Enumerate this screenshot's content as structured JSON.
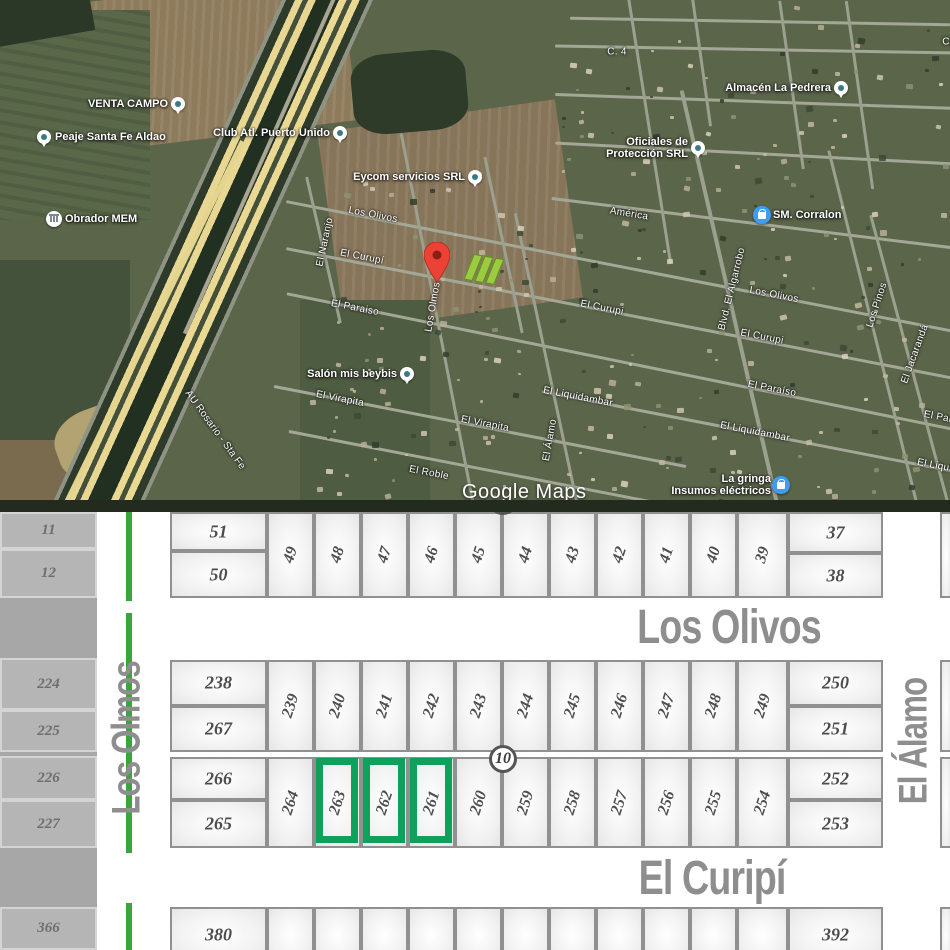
{
  "map": {
    "attribution": "Google Maps",
    "route_label": "AU Rosario - Sta Fe",
    "marker_color": "#ea4335",
    "lot_highlight_color": "#9ccb3f",
    "pois": [
      {
        "type": "place",
        "label": "VENTA CAMPO",
        "x": 178,
        "y": 104,
        "side": "left"
      },
      {
        "type": "place",
        "label": "Peaje Santa Fe Aldao",
        "x": 44,
        "y": 137,
        "side": "right"
      },
      {
        "type": "place",
        "label": "Club Atl. Puerto Unido",
        "x": 340,
        "y": 133,
        "side": "left"
      },
      {
        "type": "place",
        "label": "Eycom servicios SRL",
        "x": 475,
        "y": 177,
        "side": "left"
      },
      {
        "type": "place",
        "label": "Almacén La Pedrera",
        "x": 841,
        "y": 88,
        "side": "left"
      },
      {
        "type": "place",
        "label": "Oficiales de",
        "label2": "Protección SRL",
        "x": 698,
        "y": 148,
        "side": "left"
      },
      {
        "type": "place",
        "label": "Salón mis beybis",
        "x": 407,
        "y": 374,
        "side": "left"
      },
      {
        "type": "shop",
        "label": "SM. Corralon",
        "x": 762,
        "y": 215,
        "side": "right"
      },
      {
        "type": "shop",
        "label": "La gringa",
        "label2": "Insumos eléctricos",
        "x": 781,
        "y": 485,
        "side": "left"
      },
      {
        "type": "civic",
        "label": "Obrador MEM",
        "x": 54,
        "y": 219,
        "side": "right"
      }
    ],
    "street_labels": [
      {
        "text": "C. 4",
        "x": 617,
        "y": 52,
        "rot": 0
      },
      {
        "text": "C. 4",
        "x": 952,
        "y": 42,
        "rot": 0
      },
      {
        "text": "Los Olivos",
        "x": 373,
        "y": 215,
        "rot": 11
      },
      {
        "text": "Los Olivos",
        "x": 774,
        "y": 295,
        "rot": 11
      },
      {
        "text": "El Curupí",
        "x": 362,
        "y": 257,
        "rot": 11
      },
      {
        "text": "El Curupi",
        "x": 602,
        "y": 308,
        "rot": 11
      },
      {
        "text": "El Curupi",
        "x": 762,
        "y": 337,
        "rot": 11
      },
      {
        "text": "El Paraiso",
        "x": 355,
        "y": 308,
        "rot": 11
      },
      {
        "text": "El Paraíso",
        "x": 772,
        "y": 389,
        "rot": 11
      },
      {
        "text": "El Paraíso",
        "x": 948,
        "y": 419,
        "rot": 11
      },
      {
        "text": "El Naranjo",
        "x": 325,
        "y": 242,
        "rot": -78
      },
      {
        "text": "Los Olmos",
        "x": 433,
        "y": 307,
        "rot": -80
      },
      {
        "text": "América",
        "x": 629,
        "y": 214,
        "rot": 9
      },
      {
        "text": "Blvd. El Algarrobo",
        "x": 732,
        "y": 289,
        "rot": -76
      },
      {
        "text": "Los Pinos",
        "x": 877,
        "y": 305,
        "rot": -72
      },
      {
        "text": "El Jacarandá",
        "x": 915,
        "y": 354,
        "rot": -70
      },
      {
        "text": "El Álamo",
        "x": 550,
        "y": 440,
        "rot": -80
      },
      {
        "text": "El Virapita",
        "x": 340,
        "y": 399,
        "rot": 11
      },
      {
        "text": "El Virapita",
        "x": 485,
        "y": 424,
        "rot": 11
      },
      {
        "text": "El Liquidambar",
        "x": 578,
        "y": 397,
        "rot": 11
      },
      {
        "text": "El Liquidambar",
        "x": 755,
        "y": 432,
        "rot": 11
      },
      {
        "text": "El Liquidambar",
        "x": 952,
        "y": 469,
        "rot": 11
      },
      {
        "text": "El Roble",
        "x": 429,
        "y": 473,
        "rot": 11
      },
      {
        "text": "AU Rosario - Sta Fe",
        "x": 215,
        "y": 430,
        "rot": 54
      }
    ]
  },
  "plat": {
    "accent_green": "#0da15c",
    "divider_green": "#3aa53c",
    "block_number": "10",
    "streets": {
      "north": "Los Olivos",
      "south": "El Curipí",
      "west": "Los Olmos",
      "east": "El Álamo"
    },
    "highlighted_lots": [
      "263",
      "262",
      "261"
    ],
    "left_strip_lots": [
      {
        "n": "11",
        "y": 0,
        "h": 37
      },
      {
        "n": "12",
        "y": 37,
        "h": 49
      },
      {
        "n": "224",
        "y": 146,
        "h": 52
      },
      {
        "n": "225",
        "y": 198,
        "h": 42
      },
      {
        "n": "226",
        "y": 244,
        "h": 44
      },
      {
        "n": "227",
        "y": 288,
        "h": 48
      },
      {
        "n": "366",
        "y": 395,
        "h": 43
      }
    ],
    "lots": [
      {
        "n": "51",
        "x": 170,
        "y": 0,
        "w": 97,
        "h": 39
      },
      {
        "n": "50",
        "x": 170,
        "y": 39,
        "w": 97,
        "h": 47
      },
      {
        "n": "49",
        "x": 267,
        "y": 0,
        "w": 47,
        "h": 86,
        "rot": 1
      },
      {
        "n": "48",
        "x": 314,
        "y": 0,
        "w": 47,
        "h": 86,
        "rot": 1
      },
      {
        "n": "47",
        "x": 361,
        "y": 0,
        "w": 47,
        "h": 86,
        "rot": 1
      },
      {
        "n": "46",
        "x": 408,
        "y": 0,
        "w": 47,
        "h": 86,
        "rot": 1
      },
      {
        "n": "45",
        "x": 455,
        "y": 0,
        "w": 47,
        "h": 86,
        "rot": 1
      },
      {
        "n": "44",
        "x": 502,
        "y": 0,
        "w": 47,
        "h": 86,
        "rot": 1
      },
      {
        "n": "43",
        "x": 549,
        "y": 0,
        "w": 47,
        "h": 86,
        "rot": 1
      },
      {
        "n": "42",
        "x": 596,
        "y": 0,
        "w": 47,
        "h": 86,
        "rot": 1
      },
      {
        "n": "41",
        "x": 643,
        "y": 0,
        "w": 47,
        "h": 86,
        "rot": 1
      },
      {
        "n": "40",
        "x": 690,
        "y": 0,
        "w": 47,
        "h": 86,
        "rot": 1
      },
      {
        "n": "39",
        "x": 737,
        "y": 0,
        "w": 51,
        "h": 86,
        "rot": 1
      },
      {
        "n": "37",
        "x": 788,
        "y": 0,
        "w": 95,
        "h": 41
      },
      {
        "n": "38",
        "x": 788,
        "y": 41,
        "w": 95,
        "h": 45
      },
      {
        "n": "",
        "x": 940,
        "y": 0,
        "w": 12,
        "h": 86
      },
      {
        "n": "238",
        "x": 170,
        "y": 148,
        "w": 97,
        "h": 46
      },
      {
        "n": "267",
        "x": 170,
        "y": 194,
        "w": 97,
        "h": 46
      },
      {
        "n": "239",
        "x": 267,
        "y": 148,
        "w": 47,
        "h": 92,
        "rot": 1
      },
      {
        "n": "240",
        "x": 314,
        "y": 148,
        "w": 47,
        "h": 92,
        "rot": 1
      },
      {
        "n": "241",
        "x": 361,
        "y": 148,
        "w": 47,
        "h": 92,
        "rot": 1
      },
      {
        "n": "242",
        "x": 408,
        "y": 148,
        "w": 47,
        "h": 92,
        "rot": 1
      },
      {
        "n": "243",
        "x": 455,
        "y": 148,
        "w": 47,
        "h": 92,
        "rot": 1
      },
      {
        "n": "244",
        "x": 502,
        "y": 148,
        "w": 47,
        "h": 92,
        "rot": 1
      },
      {
        "n": "245",
        "x": 549,
        "y": 148,
        "w": 47,
        "h": 92,
        "rot": 1
      },
      {
        "n": "246",
        "x": 596,
        "y": 148,
        "w": 47,
        "h": 92,
        "rot": 1
      },
      {
        "n": "247",
        "x": 643,
        "y": 148,
        "w": 47,
        "h": 92,
        "rot": 1
      },
      {
        "n": "248",
        "x": 690,
        "y": 148,
        "w": 47,
        "h": 92,
        "rot": 1
      },
      {
        "n": "249",
        "x": 737,
        "y": 148,
        "w": 51,
        "h": 92,
        "rot": 1
      },
      {
        "n": "250",
        "x": 788,
        "y": 148,
        "w": 95,
        "h": 46
      },
      {
        "n": "251",
        "x": 788,
        "y": 194,
        "w": 95,
        "h": 46
      },
      {
        "n": "",
        "x": 940,
        "y": 148,
        "w": 12,
        "h": 92
      },
      {
        "n": "266",
        "x": 170,
        "y": 245,
        "w": 97,
        "h": 43
      },
      {
        "n": "265",
        "x": 170,
        "y": 288,
        "w": 97,
        "h": 48
      },
      {
        "n": "264",
        "x": 267,
        "y": 245,
        "w": 47,
        "h": 91,
        "rot": 1
      },
      {
        "n": "263",
        "x": 314,
        "y": 245,
        "w": 47,
        "h": 91,
        "rot": 1,
        "green": 1
      },
      {
        "n": "262",
        "x": 361,
        "y": 245,
        "w": 47,
        "h": 91,
        "rot": 1,
        "green": 1
      },
      {
        "n": "261",
        "x": 408,
        "y": 245,
        "w": 47,
        "h": 91,
        "rot": 1,
        "green": 1
      },
      {
        "n": "260",
        "x": 455,
        "y": 245,
        "w": 47,
        "h": 91,
        "rot": 1
      },
      {
        "n": "259",
        "x": 502,
        "y": 245,
        "w": 47,
        "h": 91,
        "rot": 1
      },
      {
        "n": "258",
        "x": 549,
        "y": 245,
        "w": 47,
        "h": 91,
        "rot": 1
      },
      {
        "n": "257",
        "x": 596,
        "y": 245,
        "w": 47,
        "h": 91,
        "rot": 1
      },
      {
        "n": "256",
        "x": 643,
        "y": 245,
        "w": 47,
        "h": 91,
        "rot": 1
      },
      {
        "n": "255",
        "x": 690,
        "y": 245,
        "w": 47,
        "h": 91,
        "rot": 1
      },
      {
        "n": "254",
        "x": 737,
        "y": 245,
        "w": 51,
        "h": 91,
        "rot": 1
      },
      {
        "n": "252",
        "x": 788,
        "y": 245,
        "w": 95,
        "h": 43
      },
      {
        "n": "253",
        "x": 788,
        "y": 288,
        "w": 95,
        "h": 48
      },
      {
        "n": "",
        "x": 940,
        "y": 245,
        "w": 12,
        "h": 91
      },
      {
        "n": "380",
        "x": 170,
        "y": 395,
        "w": 97,
        "h": 56
      },
      {
        "n": "381",
        "x": 267,
        "y": 395,
        "w": 47,
        "h": 56,
        "rot": 1,
        "clip": 1
      },
      {
        "n": "382",
        "x": 314,
        "y": 395,
        "w": 47,
        "h": 56,
        "rot": 1,
        "clip": 1
      },
      {
        "n": "383",
        "x": 361,
        "y": 395,
        "w": 47,
        "h": 56,
        "rot": 1,
        "clip": 1
      },
      {
        "n": "384",
        "x": 408,
        "y": 395,
        "w": 47,
        "h": 56,
        "rot": 1,
        "clip": 1
      },
      {
        "n": "385",
        "x": 455,
        "y": 395,
        "w": 47,
        "h": 56,
        "rot": 1,
        "clip": 1
      },
      {
        "n": "386",
        "x": 502,
        "y": 395,
        "w": 47,
        "h": 56,
        "rot": 1,
        "clip": 1
      },
      {
        "n": "387",
        "x": 549,
        "y": 395,
        "w": 47,
        "h": 56,
        "rot": 1,
        "clip": 1
      },
      {
        "n": "388",
        "x": 596,
        "y": 395,
        "w": 47,
        "h": 56,
        "rot": 1,
        "clip": 1
      },
      {
        "n": "389",
        "x": 643,
        "y": 395,
        "w": 47,
        "h": 56,
        "rot": 1,
        "clip": 1
      },
      {
        "n": "390",
        "x": 690,
        "y": 395,
        "w": 47,
        "h": 56,
        "rot": 1,
        "clip": 1
      },
      {
        "n": "391",
        "x": 737,
        "y": 395,
        "w": 51,
        "h": 56,
        "rot": 1,
        "clip": 1
      },
      {
        "n": "392",
        "x": 788,
        "y": 395,
        "w": 95,
        "h": 56
      },
      {
        "n": "",
        "x": 940,
        "y": 395,
        "w": 12,
        "h": 56
      }
    ]
  }
}
